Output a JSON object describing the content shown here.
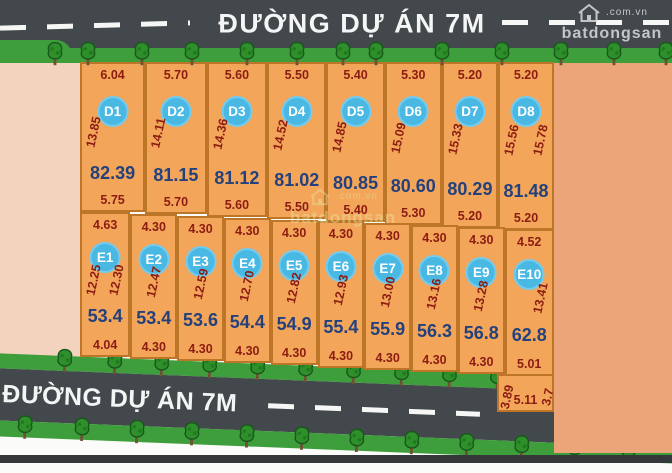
{
  "roads": {
    "top": {
      "label": "ĐƯỜNG DỰ ÁN 7M"
    },
    "bottom": {
      "label": "ĐƯỜNG DỰ ÁN 7M"
    }
  },
  "watermark": {
    "brand": "batdongsan",
    "domain": ".com.vn"
  },
  "plots": {
    "d_row": [
      {
        "id": "D1",
        "top": "6.04",
        "side": "13.85",
        "area": "82.39",
        "bottom": "5.75"
      },
      {
        "id": "D2",
        "top": "5.70",
        "side": "14.11",
        "area": "81.15",
        "bottom": "5.70"
      },
      {
        "id": "D3",
        "top": "5.60",
        "side": "14.36",
        "area": "81.12",
        "bottom": "5.60"
      },
      {
        "id": "D4",
        "top": "5.50",
        "side": "14.52",
        "area": "81.02",
        "bottom": "5.50"
      },
      {
        "id": "D5",
        "top": "5.40",
        "side": "14.85",
        "area": "80.85",
        "bottom": "5.40"
      },
      {
        "id": "D6",
        "top": "5.30",
        "side": "15.09",
        "area": "80.60",
        "bottom": "5.30"
      },
      {
        "id": "D7",
        "top": "5.20",
        "side": "15.33",
        "area": "80.29",
        "bottom": "5.20"
      },
      {
        "id": "D8",
        "top": "5.20",
        "side_left": "15.56",
        "side_right": "15.78",
        "area": "81.48",
        "bottom": "5.20"
      }
    ],
    "e_row": [
      {
        "id": "E1",
        "top": "4.63",
        "side_left": "12.25",
        "side_right": "12.30",
        "area": "53.4",
        "bottom": "4.04"
      },
      {
        "id": "E2",
        "top": "4.30",
        "side": "12.47",
        "area": "53.4",
        "bottom": "4.30"
      },
      {
        "id": "E3",
        "top": "4.30",
        "side": "12.59",
        "area": "53.6",
        "bottom": "4.30"
      },
      {
        "id": "E4",
        "top": "4.30",
        "side": "12.70",
        "area": "54.4",
        "bottom": "4.30"
      },
      {
        "id": "E5",
        "top": "4.30",
        "side": "12.82",
        "area": "54.9",
        "bottom": "4.30"
      },
      {
        "id": "E6",
        "top": "4.30",
        "side": "12.93",
        "area": "55.4",
        "bottom": "4.30"
      },
      {
        "id": "E7",
        "top": "4.30",
        "side": "13.00",
        "area": "55.9",
        "bottom": "4.30"
      },
      {
        "id": "E8",
        "top": "4.30",
        "side": "13.16",
        "area": "56.3",
        "bottom": "4.30"
      },
      {
        "id": "E9",
        "top": "4.30",
        "side": "13.28",
        "area": "56.8",
        "bottom": "4.30"
      },
      {
        "id": "E10",
        "top": "4.52",
        "side_right": "13.41",
        "area": "62.8",
        "bottom": "5.01"
      }
    ],
    "extension": {
      "side_left": "3.89",
      "side_right": "3.7",
      "bottom": "5.11"
    }
  },
  "colors": {
    "plot_fill": "#f3a65a",
    "plot_border": "#bd7527",
    "dimension_text": "#8c1c12",
    "area_text": "#24417c",
    "badge": "#49b9e4",
    "road": "#42484b",
    "green_strip": "#3f9e3c",
    "left_area": "#f4d3be",
    "right_area": "#eca578"
  }
}
